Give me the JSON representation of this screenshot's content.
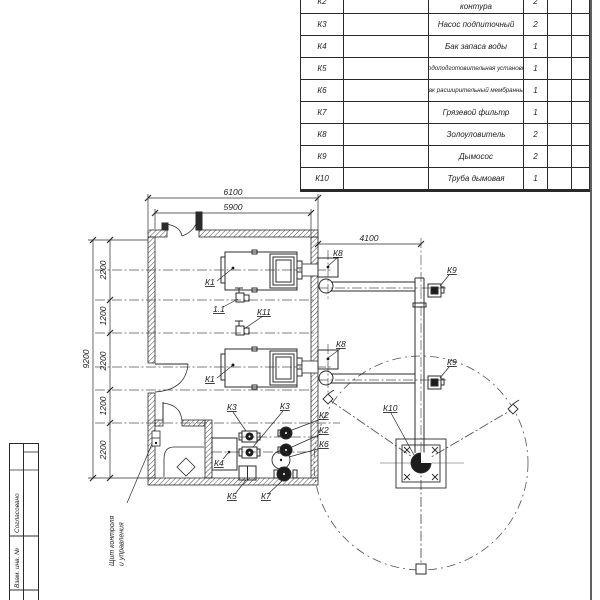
{
  "sheet_frame": {
    "soglasovano": "Согласовано",
    "vzam_inv": "Взам. инв. №"
  },
  "spec_table": {
    "rows": [
      {
        "pos": "К2",
        "name": "Насос сетевого контура",
        "qty": "2"
      },
      {
        "pos": "К3",
        "name": "Насос подпиточный",
        "qty": "2"
      },
      {
        "pos": "К4",
        "name": "Бак запаса воды",
        "qty": "1"
      },
      {
        "pos": "К5",
        "name": "Водоподготовительная установка",
        "qty": "1"
      },
      {
        "pos": "К6",
        "name": "Бак расширительный мембранный",
        "qty": "1"
      },
      {
        "pos": "К7",
        "name": "Грязевой фильтр",
        "qty": "1"
      },
      {
        "pos": "К8",
        "name": "Золоуловитель",
        "qty": "2"
      },
      {
        "pos": "К9",
        "name": "Дымосос",
        "qty": "2"
      },
      {
        "pos": "К10",
        "name": "Труба дымовая",
        "qty": "1"
      }
    ]
  },
  "dims": {
    "width_outer": "6100",
    "width_inner": "5900",
    "flue_offset": "4100",
    "height_total": "9200",
    "left_chain": [
      "2200",
      "1200",
      "2200",
      "1200",
      "2200"
    ]
  },
  "labels": {
    "k1": "К1",
    "k2": "К2",
    "k3": "К3",
    "k4": "К4",
    "k5": "К5",
    "k6": "К6",
    "k7": "К7",
    "k8": "К8",
    "k9": "К9",
    "k10": "К10",
    "k11": "К11",
    "v11": "1.1"
  },
  "annotations": {
    "control_panel_line1": "Щит контроля",
    "control_panel_line2": "и управления"
  },
  "colors": {
    "line": "#2b2b2b",
    "thin": "#555555",
    "dark_fill": "#1c1c1c",
    "background": "#ffffff"
  }
}
